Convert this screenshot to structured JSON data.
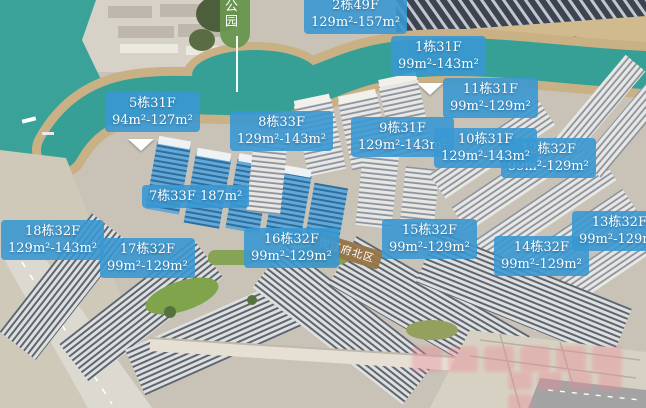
{
  "park_label": {
    "text": "公园"
  },
  "area_label": {
    "text": "悦江府北区"
  },
  "building_labels": [
    {
      "name": "building-2",
      "line1": "2栋49F",
      "line2": "129m²-157m²"
    },
    {
      "name": "building-1",
      "line1": "1栋31F",
      "line2": "99m²-143m²"
    },
    {
      "name": "building-11",
      "line1": "11栋31F",
      "line2": "99m²-129m²"
    },
    {
      "name": "building-5",
      "line1": "5栋31F",
      "line2": "94m²-127m²"
    },
    {
      "name": "building-8",
      "line1": "8栋33F",
      "line2": "129m²-143m²"
    },
    {
      "name": "building-9",
      "line1": "9栋31F",
      "line2": "129m²-143m²"
    },
    {
      "name": "building-10",
      "line1": "10栋31F",
      "line2": "129m²-143m²"
    },
    {
      "name": "building-12",
      "line1": "12栋32F",
      "line2": "99m²-129m²"
    },
    {
      "name": "building-7",
      "line1": "7栋33F 187m²",
      "line2": ""
    },
    {
      "name": "building-18",
      "line1": "18栋32F",
      "line2": "129m²-143m²"
    },
    {
      "name": "building-17",
      "line1": "17栋32F",
      "line2": "99m²-129m²"
    },
    {
      "name": "building-16",
      "line1": "16栋32F",
      "line2": "99m²-129m²"
    },
    {
      "name": "building-15",
      "line1": "15栋32F",
      "line2": "99m²-129m²"
    },
    {
      "name": "building-14",
      "line1": "14栋32F",
      "line2": "99m²-129m²"
    },
    {
      "name": "building-13",
      "line1": "13栋32F",
      "line2": "99m²-129m²"
    }
  ],
  "colors": {
    "label_bg": "#3a98d2",
    "area_label_bg": "#967446",
    "park_bg": "#68964f",
    "water": "#36a096",
    "sand": "#c9b085"
  }
}
